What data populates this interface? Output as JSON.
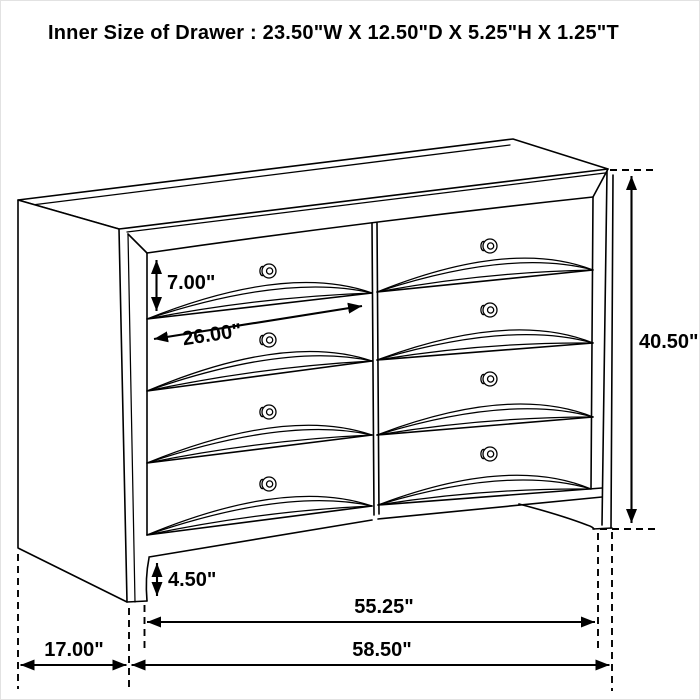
{
  "title": "Inner Size of Drawer : 23.50\"W X 12.50\"D X 5.25\"H X 1.25\"T",
  "dimensions": {
    "drawer_front_height": "7.00\"",
    "drawer_front_width": "26.00\"",
    "overall_height": "40.50\"",
    "base_height": "4.50\"",
    "inner_width": "55.25\"",
    "overall_width": "58.50\"",
    "depth": "17.00\""
  },
  "furniture": {
    "type": "dresser",
    "drawer_rows": 4,
    "drawer_columns": 2,
    "drawer_count": 8,
    "knob_count": 8
  },
  "colors": {
    "line": "#000000",
    "background": "#ffffff",
    "text": "#000000"
  }
}
